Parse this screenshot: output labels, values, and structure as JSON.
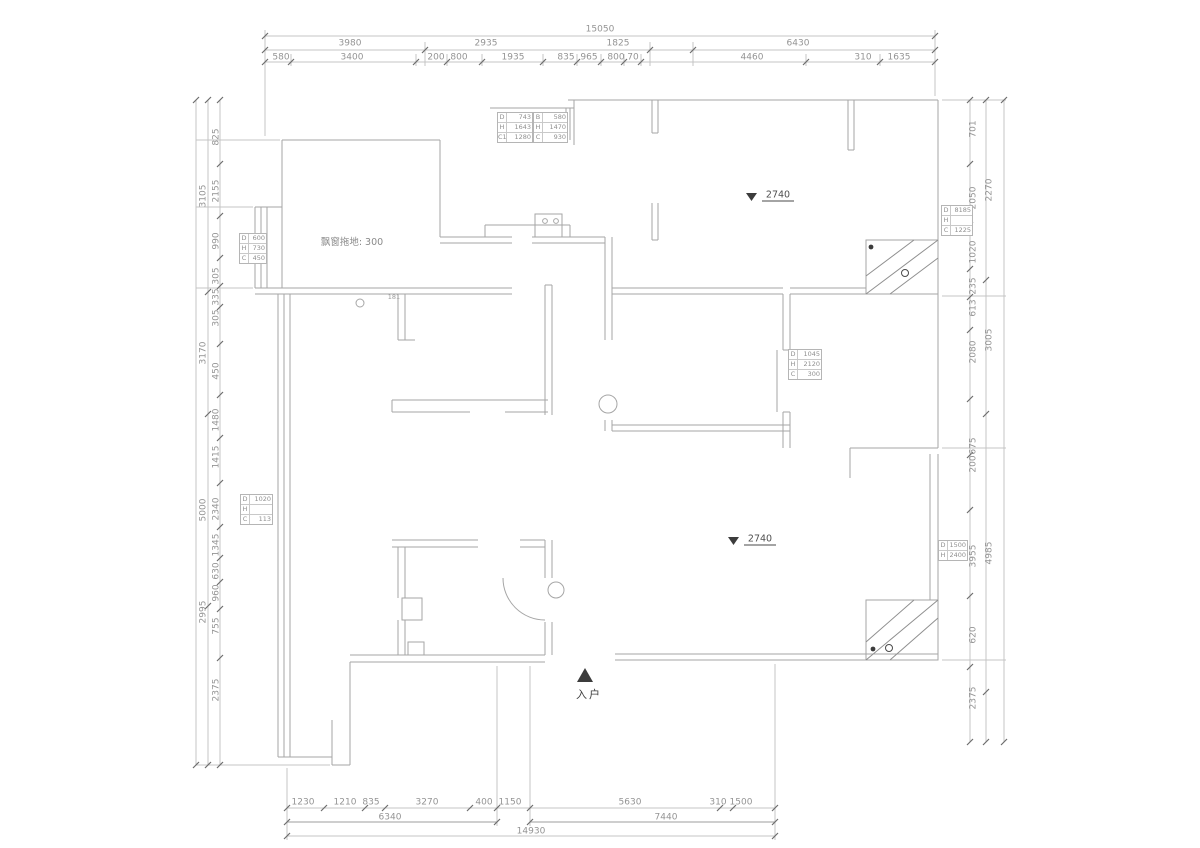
{
  "document": {
    "kind": "architectural floor plan (CAD line drawing)",
    "background": "#ffffff"
  },
  "colors": {
    "wall_line": "#a6a6a6",
    "dimension_line": "#c4c4c4",
    "tick": "#6e6e6e",
    "dim_text": "#949494",
    "dark_accent": "#3c3c3c"
  },
  "annotations": [
    {
      "t": "飘窗拖地: 300",
      "x": 352,
      "y": 241,
      "cls": "note",
      "name": "bay-window-note"
    },
    {
      "t": "2740",
      "x": 778,
      "y": 195,
      "cls": "level",
      "name": "ceiling-height-label"
    },
    {
      "t": "2740",
      "x": 760,
      "y": 539,
      "cls": "level",
      "name": "ceiling-height-label"
    },
    {
      "t": "入户",
      "x": 589,
      "y": 694,
      "cls": "entry",
      "name": "entry-label"
    },
    {
      "t": "181",
      "x": 394,
      "y": 297,
      "cls": "tiny",
      "name": "small-mark-label"
    }
  ],
  "dims": {
    "top": [
      {
        "t": "15050",
        "x": 600,
        "y": 30
      },
      {
        "t": "3980",
        "x": 350,
        "y": 44
      },
      {
        "t": "2935",
        "x": 486,
        "y": 44
      },
      {
        "t": "1825",
        "x": 618,
        "y": 44
      },
      {
        "t": "6430",
        "x": 798,
        "y": 44
      },
      {
        "t": "580",
        "x": 281,
        "y": 58
      },
      {
        "t": "3400",
        "x": 352,
        "y": 58
      },
      {
        "t": "200",
        "x": 436,
        "y": 58
      },
      {
        "t": "800",
        "x": 459,
        "y": 58
      },
      {
        "t": "1935",
        "x": 513,
        "y": 58
      },
      {
        "t": "835",
        "x": 566,
        "y": 58
      },
      {
        "t": "965",
        "x": 589,
        "y": 58
      },
      {
        "t": "800",
        "x": 616,
        "y": 58
      },
      {
        "t": "70",
        "x": 633,
        "y": 58
      },
      {
        "t": "4460",
        "x": 752,
        "y": 58
      },
      {
        "t": "310",
        "x": 863,
        "y": 58
      },
      {
        "t": "1635",
        "x": 899,
        "y": 58
      }
    ],
    "bottom": [
      {
        "t": "1230",
        "x": 303,
        "y": 803
      },
      {
        "t": "1210",
        "x": 345,
        "y": 803
      },
      {
        "t": "835",
        "x": 371,
        "y": 803
      },
      {
        "t": "3270",
        "x": 427,
        "y": 803
      },
      {
        "t": "400",
        "x": 484,
        "y": 803
      },
      {
        "t": "1150",
        "x": 510,
        "y": 803
      },
      {
        "t": "5630",
        "x": 630,
        "y": 803
      },
      {
        "t": "310",
        "x": 718,
        "y": 803
      },
      {
        "t": "1500",
        "x": 741,
        "y": 803
      },
      {
        "t": "6340",
        "x": 390,
        "y": 818
      },
      {
        "t": "7440",
        "x": 666,
        "y": 818
      },
      {
        "t": "14930",
        "x": 531,
        "y": 832
      }
    ],
    "left": [
      {
        "t": "825",
        "x": 217,
        "y": 137
      },
      {
        "t": "2155",
        "x": 217,
        "y": 191
      },
      {
        "t": "990",
        "x": 217,
        "y": 241
      },
      {
        "t": "305",
        "x": 217,
        "y": 276
      },
      {
        "t": "335",
        "x": 217,
        "y": 297
      },
      {
        "t": "305",
        "x": 217,
        "y": 318
      },
      {
        "t": "450",
        "x": 217,
        "y": 371
      },
      {
        "t": "1480",
        "x": 217,
        "y": 420
      },
      {
        "t": "1415",
        "x": 217,
        "y": 457
      },
      {
        "t": "2340",
        "x": 217,
        "y": 509
      },
      {
        "t": "1345",
        "x": 217,
        "y": 545
      },
      {
        "t": "630",
        "x": 217,
        "y": 571
      },
      {
        "t": "960",
        "x": 217,
        "y": 593
      },
      {
        "t": "755",
        "x": 217,
        "y": 626
      },
      {
        "t": "2375",
        "x": 217,
        "y": 690
      },
      {
        "t": "3105",
        "x": 204,
        "y": 196
      },
      {
        "t": "3170",
        "x": 204,
        "y": 353
      },
      {
        "t": "5000",
        "x": 204,
        "y": 510
      },
      {
        "t": "2995",
        "x": 204,
        "y": 612
      }
    ],
    "right": [
      {
        "t": "701",
        "x": 974,
        "y": 129
      },
      {
        "t": "2050",
        "x": 974,
        "y": 198
      },
      {
        "t": "1020",
        "x": 974,
        "y": 252
      },
      {
        "t": "235",
        "x": 974,
        "y": 286
      },
      {
        "t": "613",
        "x": 974,
        "y": 308
      },
      {
        "t": "2080",
        "x": 974,
        "y": 352
      },
      {
        "t": "675",
        "x": 974,
        "y": 446
      },
      {
        "t": "200",
        "x": 974,
        "y": 464
      },
      {
        "t": "3955",
        "x": 974,
        "y": 556
      },
      {
        "t": "620",
        "x": 974,
        "y": 635
      },
      {
        "t": "2375",
        "x": 974,
        "y": 698
      },
      {
        "t": "2270",
        "x": 990,
        "y": 190
      },
      {
        "t": "3005",
        "x": 990,
        "y": 340
      },
      {
        "t": "4985",
        "x": 990,
        "y": 553
      }
    ]
  },
  "window_door_tags": [
    {
      "id": "tag-kitchen-left",
      "x": 497,
      "y": 112,
      "w": 34,
      "rows": [
        [
          "D",
          "743"
        ],
        [
          "H",
          "1643"
        ],
        [
          "C1",
          "1280"
        ]
      ]
    },
    {
      "id": "tag-kitchen-right",
      "x": 533,
      "y": 112,
      "w": 33,
      "rows": [
        [
          "B",
          "580"
        ],
        [
          "H",
          "1470"
        ],
        [
          "C",
          "930"
        ]
      ]
    },
    {
      "id": "tag-right-top",
      "x": 941,
      "y": 205,
      "w": 30,
      "rows": [
        [
          "D",
          "8185"
        ],
        [
          "H",
          ""
        ],
        [
          "C",
          "1225"
        ]
      ]
    },
    {
      "id": "tag-mid-wall",
      "x": 788,
      "y": 349,
      "w": 32,
      "rows": [
        [
          "D",
          "1045"
        ],
        [
          "H",
          "2120"
        ],
        [
          "C",
          "300"
        ]
      ]
    },
    {
      "id": "tag-left-bay",
      "x": 239,
      "y": 233,
      "w": 26,
      "rows": [
        [
          "D",
          "600"
        ],
        [
          "H",
          "730"
        ],
        [
          "C",
          "450"
        ]
      ]
    },
    {
      "id": "tag-left-lower",
      "x": 240,
      "y": 494,
      "w": 31,
      "rows": [
        [
          "D",
          "1020"
        ],
        [
          "H",
          ""
        ],
        [
          "C",
          "113"
        ]
      ]
    },
    {
      "id": "tag-right-lower",
      "x": 938,
      "y": 540,
      "w": 28,
      "rows": [
        [
          "D",
          "1500"
        ],
        [
          "H",
          "2400"
        ]
      ]
    }
  ]
}
